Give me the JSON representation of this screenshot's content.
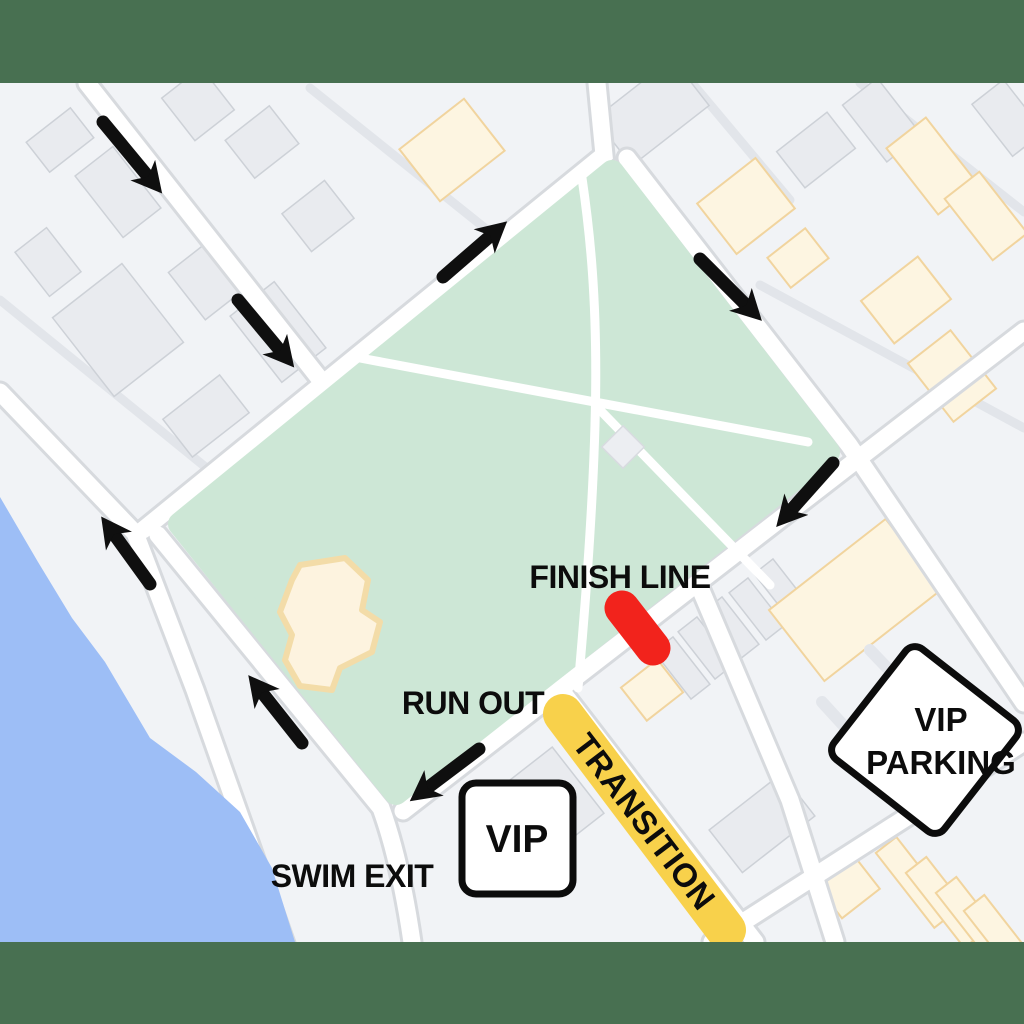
{
  "map": {
    "type": "race-course-event-map",
    "description": "Triathlon event map showing run course arrows around a park, swim exit, transition zone, finish line and VIP areas"
  },
  "labels": {
    "finish_line": "FINISH LINE",
    "run_out": "RUN OUT",
    "swim_exit": "SWIM EXIT",
    "transition": "TRANSITION",
    "vip": "VIP",
    "vip_parking_line1": "VIP",
    "vip_parking_line2": "PARKING"
  },
  "markers": {
    "finish_marker": "red-finish-line-bar",
    "transition_band": "yellow-transition-corridor",
    "course_arrows": [
      {
        "direction": "southeast"
      },
      {
        "direction": "southeast"
      },
      {
        "direction": "northeast"
      },
      {
        "direction": "southeast"
      },
      {
        "direction": "southwest"
      },
      {
        "direction": "northwest"
      },
      {
        "direction": "northwest"
      },
      {
        "direction": "southwest"
      }
    ]
  },
  "colors": {
    "frame_band": "#487051",
    "water": "#9dbef6",
    "park": "#cde7d6",
    "street": "#ffffff",
    "block_base": "#f1f3f6",
    "finish_marker": "#f2231c",
    "transition_band": "#f8d14b",
    "annotation_black": "#0c0c0c"
  }
}
